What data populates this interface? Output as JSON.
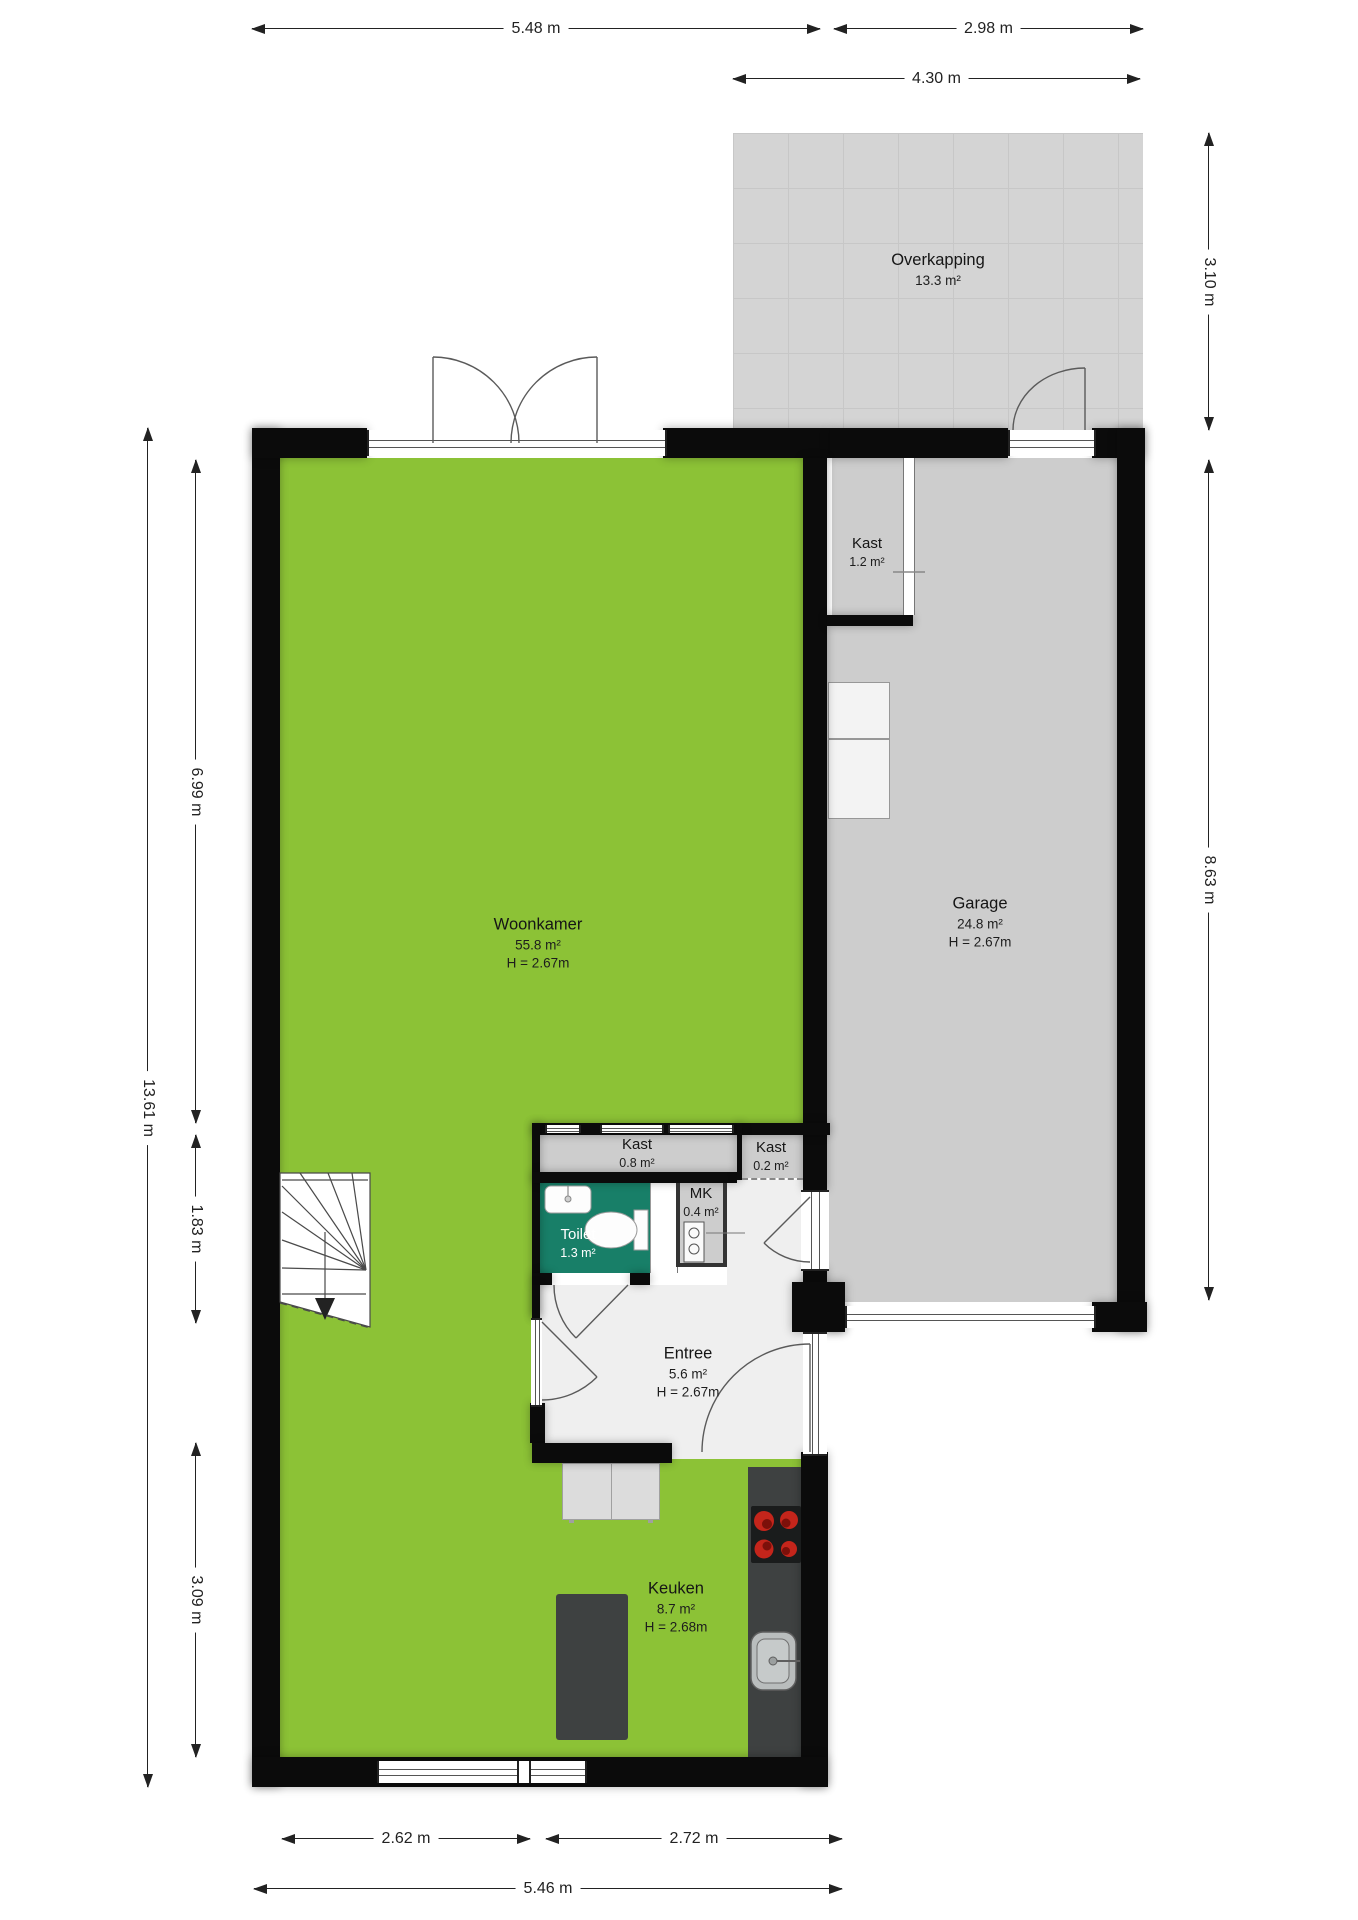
{
  "rooms": {
    "overkapping": {
      "name": "Overkapping",
      "area": "13.3 m²"
    },
    "woonkamer": {
      "name": "Woonkamer",
      "area": "55.8 m²",
      "height": "H = 2.67m"
    },
    "garage": {
      "name": "Garage",
      "area": "24.8 m²",
      "height": "H = 2.67m"
    },
    "kast_garage": {
      "name": "Kast",
      "area": "1.2 m²"
    },
    "kast_hal": {
      "name": "Kast",
      "area": "0.8 m²"
    },
    "kast_entree": {
      "name": "Kast",
      "area": "0.2 m²"
    },
    "mk": {
      "name": "MK",
      "area": "0.4 m²"
    },
    "toilet": {
      "name": "Toilet",
      "area": "1.3 m²"
    },
    "entree": {
      "name": "Entree",
      "area": "5.6 m²",
      "height": "H = 2.67m"
    },
    "keuken": {
      "name": "Keuken",
      "area": "8.7 m²",
      "height": "H = 2.68m"
    }
  },
  "dimensions": {
    "top_main": "5.48 m",
    "top_garage": "2.98 m",
    "top_overkapping": "4.30 m",
    "right_overkapping": "3.10 m",
    "right_garage": "8.63 m",
    "left_total": "13.61 m",
    "left_woonkamer": "6.99 m",
    "left_stairs": "1.83 m",
    "left_keuken": "3.09 m",
    "bottom_left": "2.62 m",
    "bottom_right": "2.72 m",
    "bottom_total": "5.46 m"
  },
  "colors": {
    "wall": "#0b0b0b",
    "green": "#8cc236",
    "garage_gray": "#cdcdcd",
    "floor_light": "#efefef",
    "teal": "#187f68",
    "counter_dark": "#3e4141",
    "overkapping": "#d4d4d4",
    "overkapping_grid": "#c7c7c7",
    "line": "#555555",
    "dim": "#222222",
    "stove_red": "#c4251b",
    "cabinet_gray": "#dcdcdc",
    "unit_white": "#f3f3f3"
  }
}
